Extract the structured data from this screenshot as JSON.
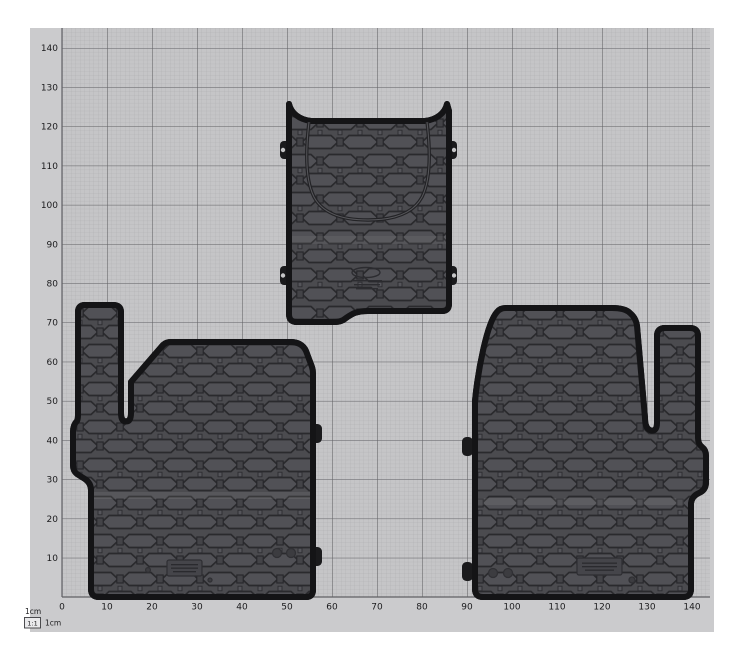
{
  "scene": {
    "name": "floor-mats-on-measuring-grid",
    "description": "Photo of three dark rubber vehicle floor mats laid out on a light grey 1 cm measuring grid board"
  },
  "colors": {
    "page_background": "#ffffff",
    "board": "#cbcbcd",
    "grid_background": "#c5c5c7",
    "grid_minor_line": "#aeaeb0",
    "grid_major_line": "#606064",
    "label_text": "#1b1b1d",
    "mat_base": "#4b4b4f",
    "mat_hex_fill": "#515156",
    "mat_pattern_line": "#2a2a2d",
    "mat_edge": "#141416",
    "mat_rim": "#3c3c40"
  },
  "ruler": {
    "unit": "cm",
    "x_labels": [
      "0",
      "10",
      "20",
      "30",
      "40",
      "50",
      "60",
      "70",
      "80",
      "90",
      "100",
      "110",
      "120",
      "130",
      "140"
    ],
    "y_labels": [
      "140",
      "130",
      "120",
      "110",
      "100",
      "90",
      "80",
      "70",
      "60",
      "50",
      "40",
      "30",
      "20",
      "10"
    ]
  },
  "legend": {
    "top_label": "1cm",
    "scale_box_label": "1:1",
    "side_label": "1cm"
  },
  "mats": [
    {
      "name": "center mat",
      "position": "top-center",
      "approx_extent_cm": {
        "x_min": 50,
        "x_max": 86,
        "y_min": 70,
        "y_max": 126
      },
      "features": "U-shaped trim groove, 4 side fixing clips, embossed oval logo"
    },
    {
      "name": "left mat",
      "position": "bottom-left",
      "approx_extent_cm": {
        "x_min": 2,
        "x_max": 56,
        "y_min": 0,
        "y_max": 75
      },
      "features": "tall narrow tongue at top-left, 2 fixing tabs on right edge, embossed label plate"
    },
    {
      "name": "right mat",
      "position": "bottom-right",
      "approx_extent_cm": {
        "x_min": 91,
        "x_max": 143,
        "y_min": 0,
        "y_max": 74
      },
      "features": "tall narrow tongue at top-right, 2 fixing tabs on left edge, embossed label plate"
    }
  ]
}
